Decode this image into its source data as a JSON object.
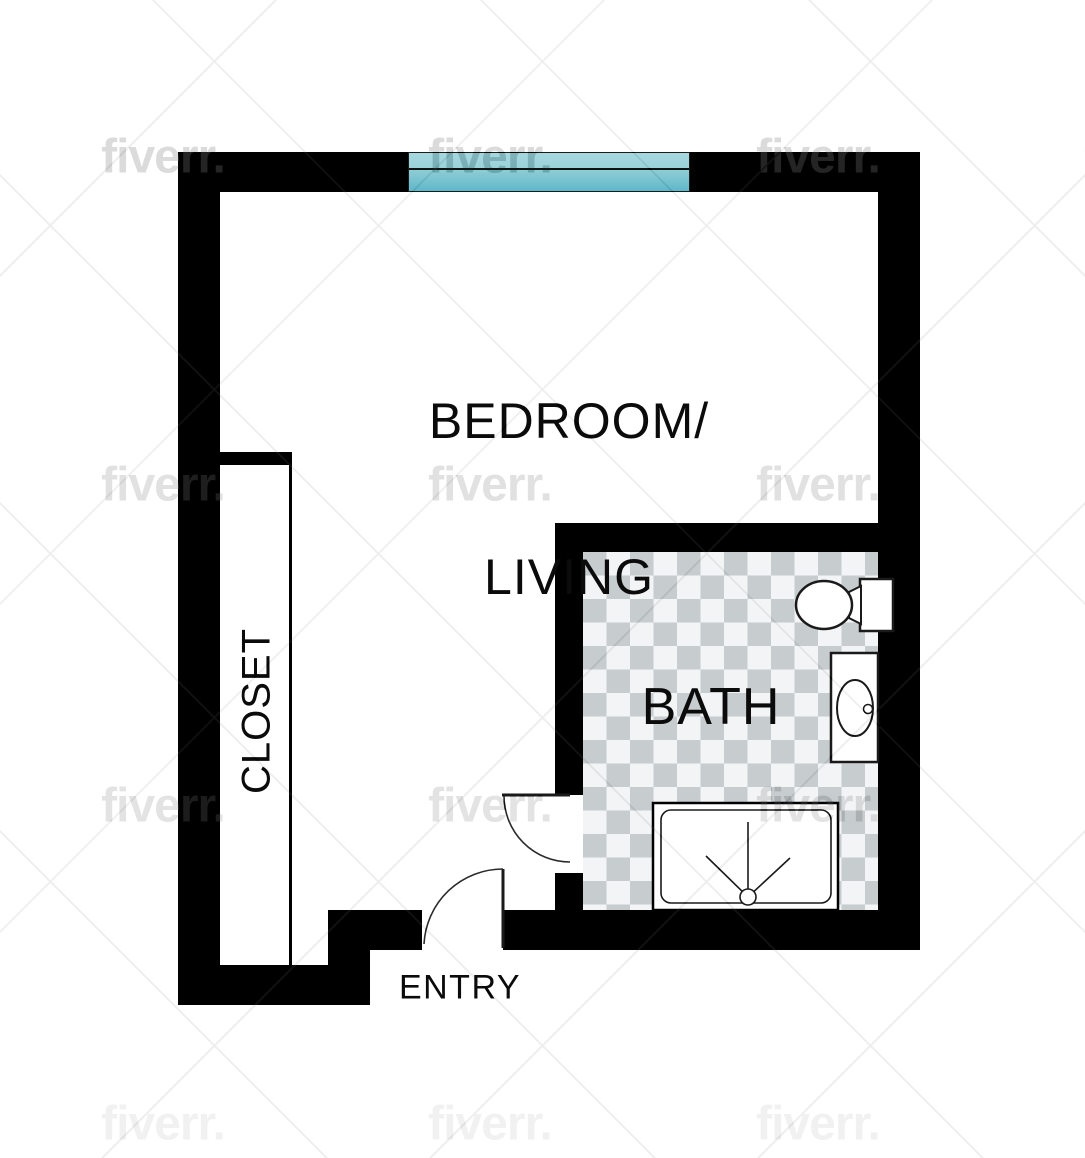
{
  "plan": {
    "title": "Studio apartment floor plan",
    "rooms": {
      "bedroom_living": {
        "line1": "BEDROOM/",
        "line2": "LIVING"
      },
      "closet": {
        "label": "CLOSET"
      },
      "bath": {
        "label": "BATH"
      },
      "entry": {
        "label": "ENTRY"
      }
    },
    "fixtures": [
      "toilet",
      "sink",
      "shower",
      "bath-door",
      "entry-door",
      "window"
    ]
  },
  "watermark": {
    "text": "fiverr."
  },
  "colors": {
    "wall": "#000000",
    "window_teal_top": "#a7d7de",
    "window_teal_bottom": "#5eb8c8",
    "checker_light": "#f2f4f5",
    "checker_dark": "#c7cccf",
    "label_text": "#0b0b0b"
  }
}
